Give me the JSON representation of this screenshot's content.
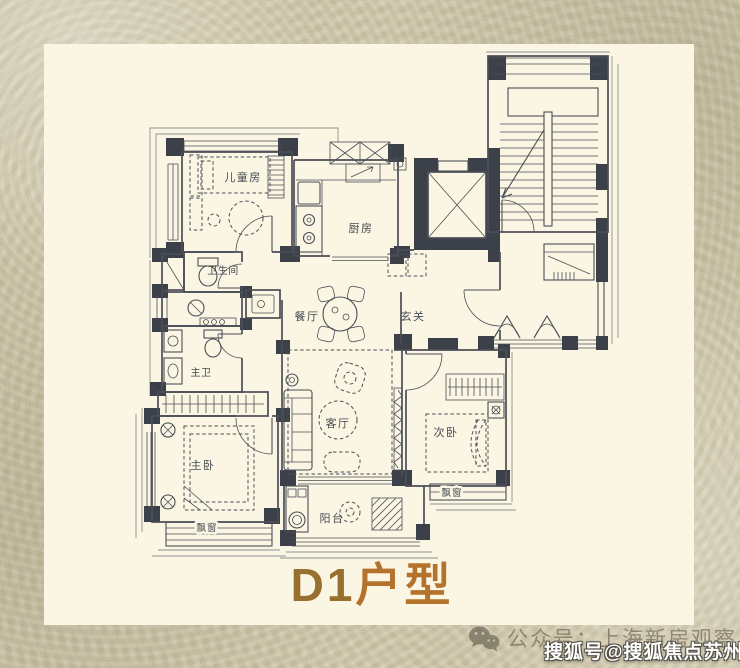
{
  "plan": {
    "title": {
      "code": "D1",
      "suffix": "户型"
    },
    "rooms": {
      "children_room": "儿童房",
      "kitchen": "厨房",
      "bathroom": "卫生间",
      "master_bathroom": "主卫",
      "dining_room": "餐厅",
      "entry": "玄关",
      "living_room": "客厅",
      "master_bedroom": "主卧",
      "second_bedroom": "次卧",
      "balcony": "阳台",
      "bay_window": "飘窗"
    }
  },
  "watermarks": {
    "wechat_account": "公众号：上海新房观察",
    "sohu_account": "搜狐号@搜狐焦点苏州站",
    "wechat_icon": "wechat-icon"
  },
  "colors": {
    "background": "#d1c9ac",
    "card": "#fbf6e3",
    "line": "#4a4e57",
    "wall_fill": "#3c4049",
    "title_left": "#97702f",
    "title_right": "#b4722c",
    "watermark_gray": "#645e4c",
    "watermark_white": "#ffffff"
  }
}
